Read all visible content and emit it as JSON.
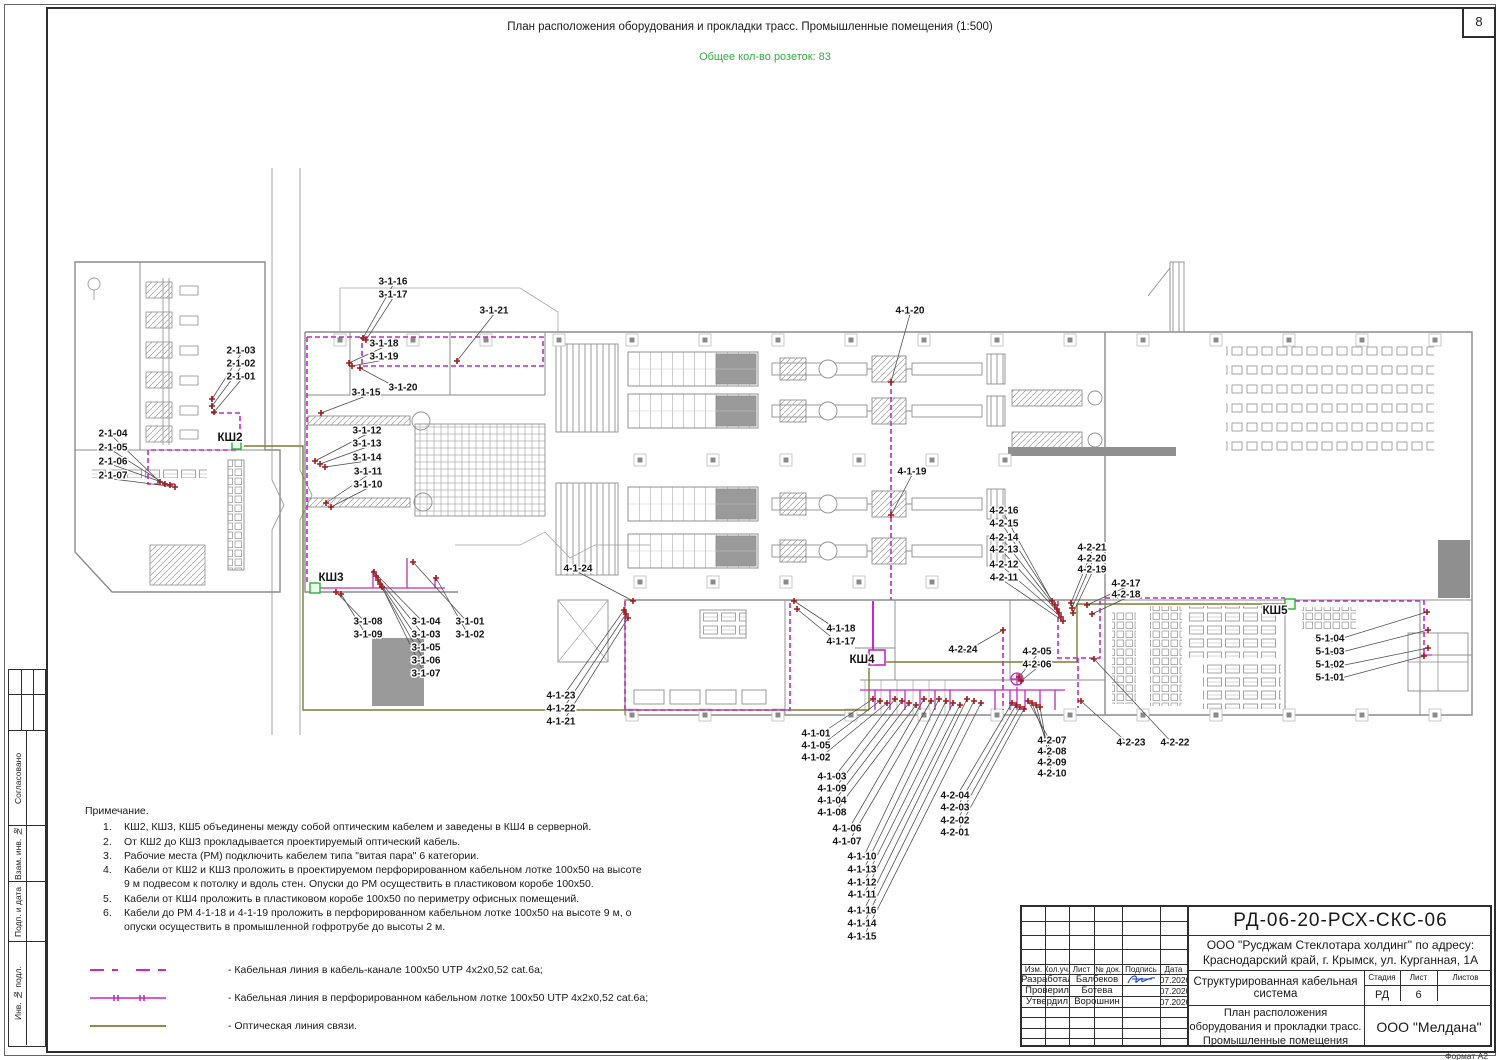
{
  "page": {
    "number": "8",
    "format": "Формат А2"
  },
  "header": {
    "title": "План расположения оборудования и прокладки трасс. Промышленные помещения (1:500)",
    "subtitle": "Общее кол-во розеток: 83"
  },
  "margin": {
    "items": [
      "Согласовано",
      "Взам. инв. №",
      "Подп. и дата",
      "Инв. № подл."
    ]
  },
  "notes": {
    "title": "Примечание.",
    "items": [
      {
        "n": "1.",
        "text": "КШ2, КШ3, КШ5 объединены между собой оптическим кабелем и заведены в КШ4 в серверной."
      },
      {
        "n": "2.",
        "text": "От КШ2 до КШ3 прокладывается проектируемый оптический кабель."
      },
      {
        "n": "3.",
        "text": "Рабочие места (РМ) подключить кабелем типа \"витая пара\" 6 категории."
      },
      {
        "n": "4.",
        "text": "Кабели от КШ2 и КШ3 проложить в проектируемом перфорированном кабельном лотке 100х50 на высоте 9 м подвесом к потолку и вдоль стен. Опуски до РМ осуществить в пластиковом коробе 100х50."
      },
      {
        "n": "5.",
        "text": "Кабели от КШ4 проложить в пластиковом коробе 100х50 по периметру офисных помещений."
      },
      {
        "n": "6.",
        "text": "Кабели до РМ 4-1-18 и 4-1-19 проложить в перфорированном кабельном лотке 100х50 на высоте 9 м, о опуски осуществить в промышленной гофротрубе до высоты 2 м."
      }
    ]
  },
  "legend": {
    "items": [
      {
        "type": "dashed-cable",
        "label": "- Кабельная линия в кабель-канале 100х50 UTP 4х2х0,52 cat.6а;"
      },
      {
        "type": "tray-cable",
        "label": "- Кабельная линия в перфорированном кабельном лотке 100х50 UTP 4х2х0,52 cat.6а;"
      },
      {
        "type": "optic",
        "label": "- Оптическая линия связи."
      }
    ]
  },
  "stamp": {
    "doc_number": "РД-06-20-РСХ-СКС-06",
    "company": [
      "ООО \"Русджам Стеклотара холдинг\" по адресу:",
      "Краснодарский край, г. Крымск, ул. Курганная, 1А"
    ],
    "system": "Структурированная кабельная система",
    "plan_title": [
      "План расположения",
      "оборудования и прокладки трасс.",
      "Промышленные помещения"
    ],
    "org": "ООО \"Мелдана\"",
    "cols": [
      "Изм.",
      "Кол.уч.",
      "Лист",
      "№ док.",
      "Подпись",
      "Дата"
    ],
    "rows": [
      {
        "role": "Разработал",
        "name": "Балбеков",
        "date": "07.2020"
      },
      {
        "role": "Проверил",
        "name": "Ботева",
        "date": "07.2020"
      },
      {
        "role": "Утвердил",
        "name": "Ворошнин",
        "date": "07.2020"
      }
    ],
    "stage_label": "Стадия",
    "sheet_label": "Лист",
    "sheets_label": "Листов",
    "stage": "РД",
    "sheet": "6",
    "sheets": ""
  },
  "colors": {
    "cable": "#c42ac4",
    "optic": "#7d7d35",
    "outlet": "#9e1b1b",
    "green": "#2fae3e",
    "leader": "#4a4a4a"
  },
  "plan": {
    "cabinets": [
      {
        "t": "КШ2",
        "x": 230,
        "y": 437
      },
      {
        "t": "КШ3",
        "x": 331,
        "y": 577
      },
      {
        "t": "КШ4",
        "x": 862,
        "y": 659
      },
      {
        "t": "КШ5",
        "x": 1275,
        "y": 610
      }
    ],
    "labels": [
      {
        "t": "2-1-03",
        "x": 241,
        "y": 350,
        "ax": 212,
        "ay": 399
      },
      {
        "t": "2-1-02",
        "x": 241,
        "y": 363,
        "ax": 212,
        "ay": 406
      },
      {
        "t": "2-1-01",
        "x": 241,
        "y": 376,
        "ax": 214,
        "ay": 412
      },
      {
        "t": "2-1-04",
        "x": 113,
        "y": 433,
        "ax": 160,
        "ay": 482
      },
      {
        "t": "2-1-05",
        "x": 113,
        "y": 447,
        "ax": 165,
        "ay": 484
      },
      {
        "t": "2-1-06",
        "x": 113,
        "y": 461,
        "ax": 170,
        "ay": 485
      },
      {
        "t": "2-1-07",
        "x": 113,
        "y": 475,
        "ax": 175,
        "ay": 487
      },
      {
        "t": "3-1-16",
        "x": 393,
        "y": 281,
        "ax": 363,
        "ay": 338
      },
      {
        "t": "3-1-17",
        "x": 393,
        "y": 294,
        "ax": 366,
        "ay": 340
      },
      {
        "t": "3-1-21",
        "x": 494,
        "y": 310,
        "ax": 457,
        "ay": 361
      },
      {
        "t": "3-1-18",
        "x": 384,
        "y": 343,
        "ax": 349,
        "ay": 363
      },
      {
        "t": "3-1-19",
        "x": 384,
        "y": 356,
        "ax": 352,
        "ay": 366
      },
      {
        "t": "3-1-20",
        "x": 403,
        "y": 387,
        "ax": 360,
        "ay": 368
      },
      {
        "t": "3-1-15",
        "x": 366,
        "y": 392,
        "ax": 321,
        "ay": 413
      },
      {
        "t": "3-1-12",
        "x": 367,
        "y": 430,
        "ax": 315,
        "ay": 461
      },
      {
        "t": "3-1-13",
        "x": 367,
        "y": 443,
        "ax": 320,
        "ay": 464
      },
      {
        "t": "3-1-14",
        "x": 367,
        "y": 457,
        "ax": 325,
        "ay": 467
      },
      {
        "t": "3-1-11",
        "x": 368,
        "y": 471,
        "ax": 326,
        "ay": 503
      },
      {
        "t": "3-1-10",
        "x": 368,
        "y": 484,
        "ax": 331,
        "ay": 507
      },
      {
        "t": "3-1-08",
        "x": 368,
        "y": 621,
        "ax": 336,
        "ay": 592
      },
      {
        "t": "3-1-09",
        "x": 368,
        "y": 634,
        "ax": 341,
        "ay": 594
      },
      {
        "t": "3-1-04",
        "x": 426,
        "y": 621,
        "ax": 374,
        "ay": 572
      },
      {
        "t": "3-1-03",
        "x": 426,
        "y": 634,
        "ax": 376,
        "ay": 576
      },
      {
        "t": "3-1-05",
        "x": 426,
        "y": 647,
        "ax": 378,
        "ay": 580
      },
      {
        "t": "3-1-06",
        "x": 426,
        "y": 660,
        "ax": 380,
        "ay": 584
      },
      {
        "t": "3-1-07",
        "x": 426,
        "y": 673,
        "ax": 382,
        "ay": 587
      },
      {
        "t": "3-1-01",
        "x": 470,
        "y": 621,
        "ax": 413,
        "ay": 562
      },
      {
        "t": "3-1-02",
        "x": 470,
        "y": 634,
        "ax": 436,
        "ay": 578
      },
      {
        "t": "4-1-24",
        "x": 578,
        "y": 568,
        "ax": 633,
        "ay": 601
      },
      {
        "t": "4-1-23",
        "x": 561,
        "y": 695,
        "ax": 624,
        "ay": 610
      },
      {
        "t": "4-1-22",
        "x": 561,
        "y": 708,
        "ax": 626,
        "ay": 614
      },
      {
        "t": "4-1-21",
        "x": 561,
        "y": 721,
        "ax": 628,
        "ay": 618
      },
      {
        "t": "4-1-18",
        "x": 841,
        "y": 628,
        "ax": 794,
        "ay": 601
      },
      {
        "t": "4-1-17",
        "x": 841,
        "y": 641,
        "ax": 797,
        "ay": 609
      },
      {
        "t": "4-1-20",
        "x": 910,
        "y": 310,
        "ax": 891,
        "ay": 382
      },
      {
        "t": "4-1-19",
        "x": 912,
        "y": 471,
        "ax": 891,
        "ay": 515
      },
      {
        "t": "4-2-24",
        "x": 963,
        "y": 649,
        "ax": 1003,
        "ay": 630
      },
      {
        "t": "4-2-05",
        "x": 1037,
        "y": 651,
        "ax": 1019,
        "ay": 677
      },
      {
        "t": "4-2-06",
        "x": 1037,
        "y": 664,
        "ax": 1021,
        "ay": 681
      },
      {
        "t": "4-2-16",
        "x": 1004,
        "y": 510,
        "ax": 1052,
        "ay": 601
      },
      {
        "t": "4-2-15",
        "x": 1004,
        "y": 523,
        "ax": 1055,
        "ay": 605
      },
      {
        "t": "4-2-14",
        "x": 1004,
        "y": 537,
        "ax": 1057,
        "ay": 609
      },
      {
        "t": "4-2-13",
        "x": 1004,
        "y": 549,
        "ax": 1059,
        "ay": 613
      },
      {
        "t": "4-2-12",
        "x": 1004,
        "y": 564,
        "ax": 1061,
        "ay": 617
      },
      {
        "t": "4-2-11",
        "x": 1004,
        "y": 577,
        "ax": 1063,
        "ay": 621
      },
      {
        "t": "4-2-21",
        "x": 1092,
        "y": 547,
        "ax": 1071,
        "ay": 603
      },
      {
        "t": "4-2-20",
        "x": 1092,
        "y": 558,
        "ax": 1072,
        "ay": 608
      },
      {
        "t": "4-2-19",
        "x": 1092,
        "y": 569,
        "ax": 1073,
        "ay": 613
      },
      {
        "t": "4-2-17",
        "x": 1126,
        "y": 583,
        "ax": 1087,
        "ay": 605
      },
      {
        "t": "4-2-18",
        "x": 1126,
        "y": 594,
        "ax": 1092,
        "ay": 614
      },
      {
        "t": "4-2-23",
        "x": 1131,
        "y": 742,
        "ax": 1081,
        "ay": 701
      },
      {
        "t": "4-2-22",
        "x": 1175,
        "y": 742,
        "ax": 1094,
        "ay": 659
      },
      {
        "t": "5-1-04",
        "x": 1330,
        "y": 638,
        "ax": 1427,
        "ay": 612
      },
      {
        "t": "5-1-03",
        "x": 1330,
        "y": 651,
        "ax": 1428,
        "ay": 630
      },
      {
        "t": "5-1-02",
        "x": 1330,
        "y": 664,
        "ax": 1428,
        "ay": 648
      },
      {
        "t": "5-1-01",
        "x": 1330,
        "y": 677,
        "ax": 1424,
        "ay": 656
      },
      {
        "t": "4-1-01",
        "x": 816,
        "y": 733,
        "ax": 873,
        "ay": 699
      },
      {
        "t": "4-1-05",
        "x": 816,
        "y": 745,
        "ax": 880,
        "ay": 701
      },
      {
        "t": "4-1-02",
        "x": 816,
        "y": 757,
        "ax": 887,
        "ay": 703
      },
      {
        "t": "4-1-03",
        "x": 832,
        "y": 776,
        "ax": 895,
        "ay": 699
      },
      {
        "t": "4-1-09",
        "x": 832,
        "y": 788,
        "ax": 902,
        "ay": 701
      },
      {
        "t": "4-1-04",
        "x": 832,
        "y": 800,
        "ax": 909,
        "ay": 703
      },
      {
        "t": "4-1-08",
        "x": 832,
        "y": 812,
        "ax": 916,
        "ay": 705
      },
      {
        "t": "4-1-06",
        "x": 847,
        "y": 828,
        "ax": 924,
        "ay": 699
      },
      {
        "t": "4-1-07",
        "x": 847,
        "y": 841,
        "ax": 931,
        "ay": 701
      },
      {
        "t": "4-1-10",
        "x": 862,
        "y": 856,
        "ax": 939,
        "ay": 699
      },
      {
        "t": "4-1-13",
        "x": 862,
        "y": 869,
        "ax": 946,
        "ay": 701
      },
      {
        "t": "4-1-12",
        "x": 862,
        "y": 882,
        "ax": 953,
        "ay": 703
      },
      {
        "t": "4-1-11",
        "x": 862,
        "y": 894,
        "ax": 960,
        "ay": 705
      },
      {
        "t": "4-1-16",
        "x": 862,
        "y": 910,
        "ax": 967,
        "ay": 699
      },
      {
        "t": "4-1-14",
        "x": 862,
        "y": 923,
        "ax": 974,
        "ay": 701
      },
      {
        "t": "4-1-15",
        "x": 862,
        "y": 936,
        "ax": 981,
        "ay": 703
      },
      {
        "t": "4-2-04",
        "x": 955,
        "y": 795,
        "ax": 1012,
        "ay": 703
      },
      {
        "t": "4-2-03",
        "x": 955,
        "y": 807,
        "ax": 1016,
        "ay": 705
      },
      {
        "t": "4-2-02",
        "x": 955,
        "y": 820,
        "ax": 1020,
        "ay": 707
      },
      {
        "t": "4-2-01",
        "x": 955,
        "y": 832,
        "ax": 1024,
        "ay": 709
      },
      {
        "t": "4-2-07",
        "x": 1052,
        "y": 740,
        "ax": 1028,
        "ay": 701
      },
      {
        "t": "4-2-08",
        "x": 1052,
        "y": 751,
        "ax": 1032,
        "ay": 703
      },
      {
        "t": "4-2-09",
        "x": 1052,
        "y": 762,
        "ax": 1036,
        "ay": 705
      },
      {
        "t": "4-2-10",
        "x": 1052,
        "y": 773,
        "ax": 1040,
        "ay": 707
      }
    ]
  }
}
